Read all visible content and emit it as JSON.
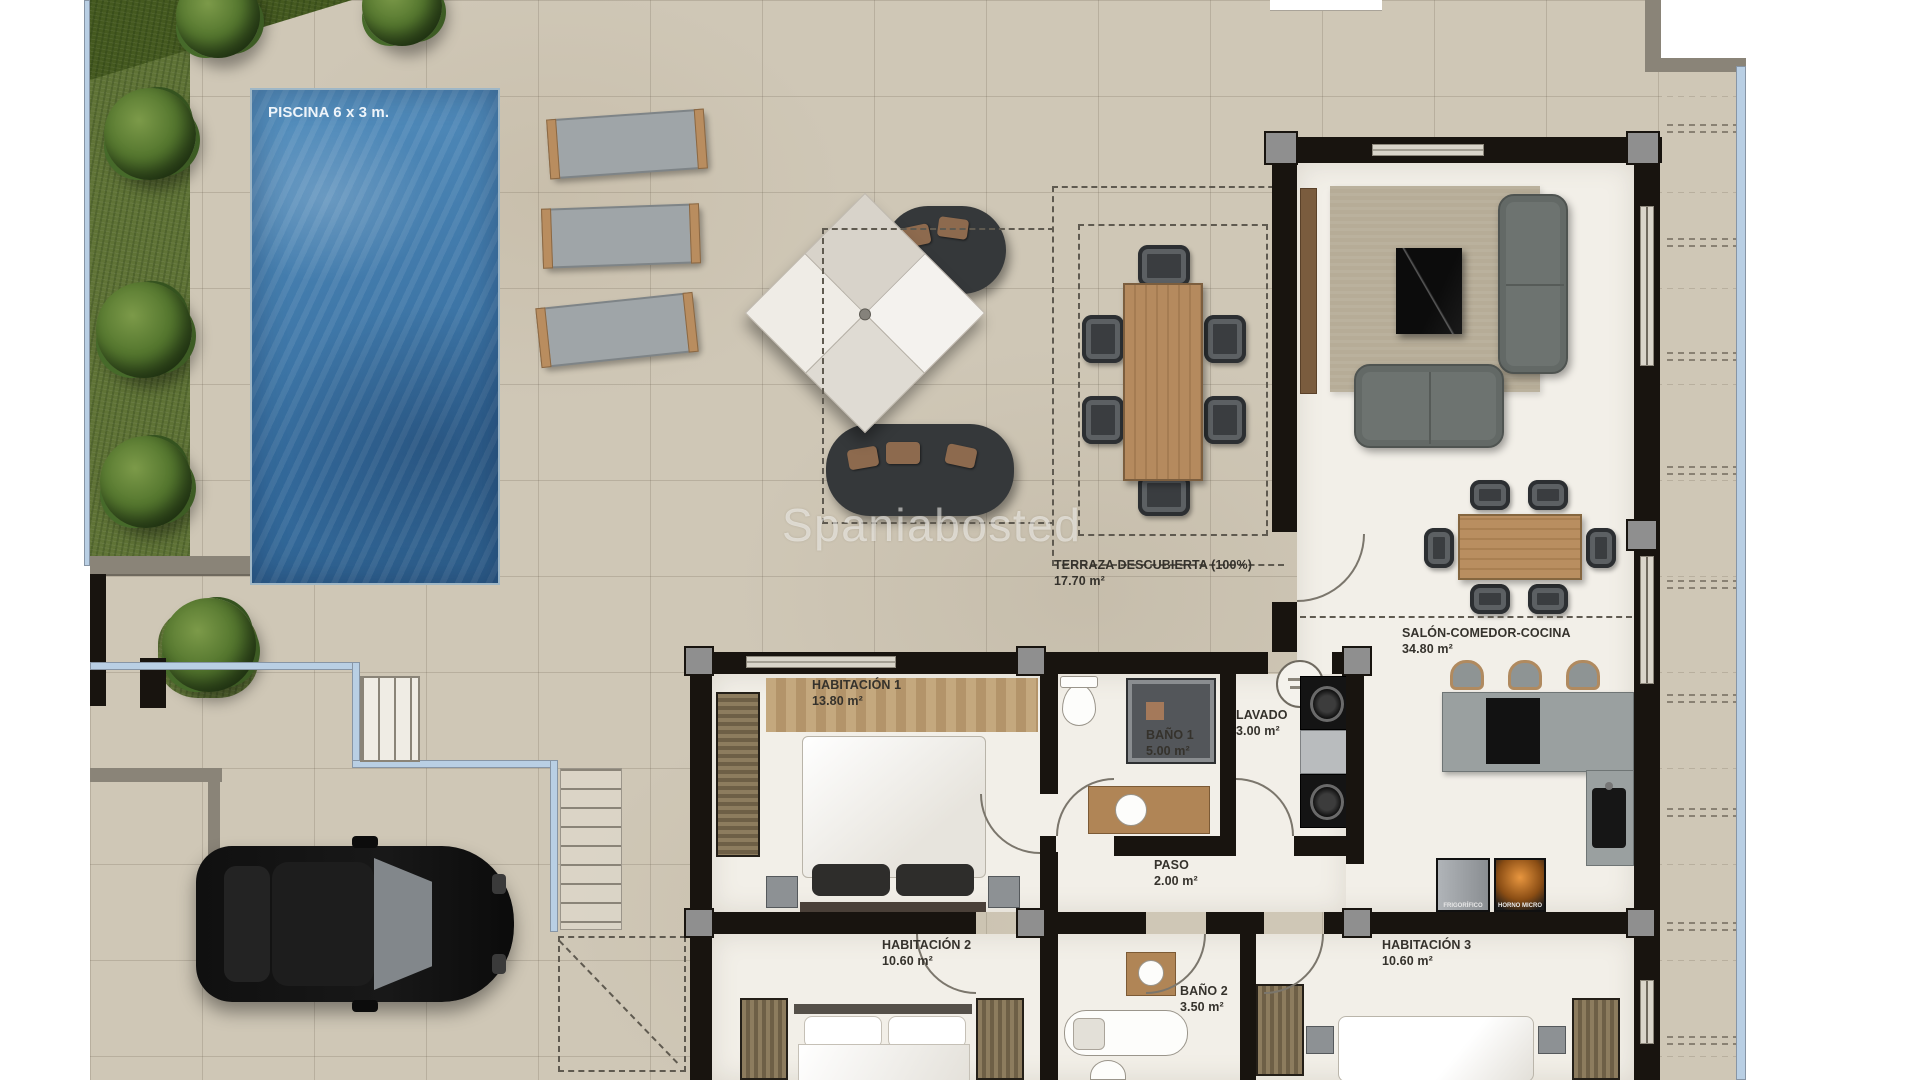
{
  "plan": {
    "watermark": "Spaniabosted",
    "pool_label": "PISCINA 6 x 3 m.",
    "rooms": {
      "terraza": {
        "name": "TERRAZA DESCUBIERTA (100%)",
        "area": "17.70 m²"
      },
      "salon": {
        "name": "SALÓN-COMEDOR-COCINA",
        "area": "34.80 m²"
      },
      "hab1": {
        "name": "HABITACIÓN 1",
        "area": "13.80 m²"
      },
      "bano1": {
        "name": "BAÑO 1",
        "area": "5.00 m²"
      },
      "lavado": {
        "name": "LAVADO",
        "area": "3.00 m²"
      },
      "paso": {
        "name": "PASO",
        "area": "2.00 m²"
      },
      "hab2": {
        "name": "HABITACIÓN 2",
        "area": "10.60 m²"
      },
      "bano2": {
        "name": "BAÑO 2",
        "area": "3.50 m²"
      },
      "hab3": {
        "name": "HABITACIÓN 3",
        "area": "10.60 m²"
      }
    },
    "appliances": {
      "fridge": "FRIGORÍFICO",
      "oven": "HORNO MICRO"
    },
    "colors": {
      "pool": "#3f7fb3",
      "walls": "#18140f",
      "tiles": "#cfc7b6",
      "indoor_floor": "#f2efe8",
      "balustrade_blue": "#b9cfe4",
      "grass": "#5f7336"
    }
  }
}
